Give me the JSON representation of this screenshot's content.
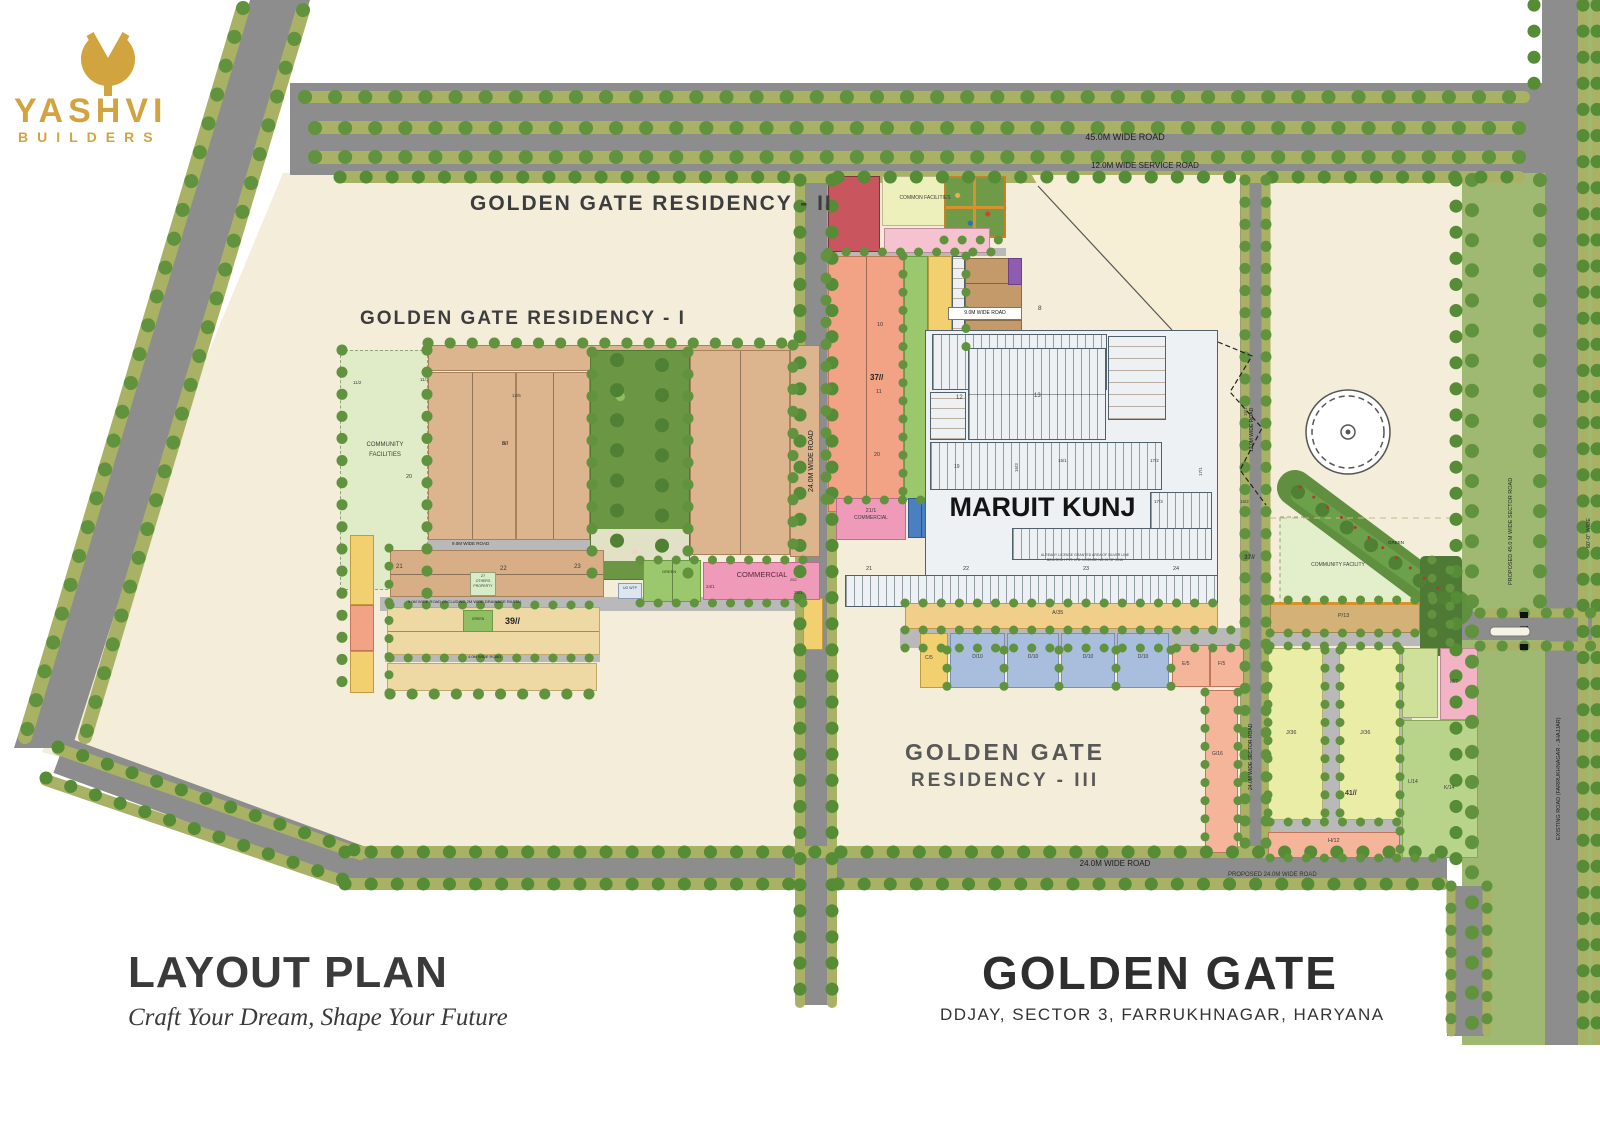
{
  "brand": {
    "name": "YASHVI",
    "subtitle": "BUILDERS",
    "color": "#d2a440"
  },
  "titles": {
    "residency2": "GOLDEN GATE RESIDENCY - II",
    "residency1": "GOLDEN GATE RESIDENCY - I",
    "res3a": "GOLDEN GATE",
    "res3b": "RESIDENCY - III",
    "maruit": "MARUIT KUNJ",
    "note1": "ALREADY LICENSE GRANTED AREA OF SILVER LINE",
    "note2": "BELLTECH PVT. LTD. LICENSE NO.91 OF 2015"
  },
  "footer": {
    "title": "LAYOUT PLAN",
    "tagline": "Craft Your Dream, Shape Your Future",
    "project": "GOLDEN GATE",
    "location": "DDJAY, SECTOR 3, FARRUKHNAGAR, HARYANA"
  },
  "roads": {
    "r45": "45.0M WIDE ROAD",
    "service": "12.0M WIDE SERVICE ROAD",
    "mid24": "24.0M WIDE ROAD",
    "bottom24": "24.0M WIDE ROAD",
    "proposed24": "PROPOSED 24.0M WIDE ROAD",
    "nine": "9.0M WIDE ROAD",
    "nine_drain": "9.0M WIDE ROAD (INCLUDING 2M WIDE DRAINAGE RASTA)",
    "four": "4.0M WIDE ROAD",
    "nine_ii": "9.0M WIDE ROAD",
    "sector24": "24.0M WIDE SECTOR ROAD",
    "east12": "12.0M WIDE ROAD",
    "proposed45": "PROPOSED 45.0 M WIDE SECTOR ROAD",
    "existing": "EXISTING ROAD (FARRUKHNAGAR - JHAJJAR)",
    "wide60": "60'-0\" WIDE"
  },
  "labels": {
    "common_facilities": "COMMON FACILITIES",
    "community_a": "COMMUNITY",
    "community_b": "FACILITIES",
    "community_facility": "COMMUNITY FACILITY",
    "commercial": "COMMERCIAL",
    "c21a": "21/1",
    "c21b": "COMMERCIAL",
    "c24": "24/1",
    "c25": "25/1",
    "green": "GREEN",
    "ug_wtp": "UG WTP",
    "o27a": "27",
    "o27b": "OTHERS",
    "o27c": "PROPERTY",
    "b37": "37//",
    "b39": "39//",
    "b41": "41//",
    "b8s": "8//",
    "n8": "8",
    "n10": "10",
    "n11": "11",
    "n12": "12",
    "n13": "13",
    "n19": "19",
    "n20": "20",
    "n21": "21",
    "n22": "22",
    "n23": "23",
    "n24": "24",
    "n252": "252",
    "s11_1": "11/1",
    "s11_2": "11/2",
    "s12_5": "12/5",
    "s15_1": "15/1",
    "s15_2": "15/2",
    "s16_3": "16/3",
    "s17_1": "17/1",
    "s17_2": "17/2",
    "s17_3": "17/3",
    "a35": "A/35",
    "c5": "C/5",
    "d10": "D/10",
    "e5": "E/5",
    "f5": "F/5",
    "g16": "G/16",
    "h12": "H/12",
    "j36": "J/36",
    "k14": "K/14",
    "l14": "L/14",
    "m7": "M/7",
    "p13": "P/13"
  }
}
